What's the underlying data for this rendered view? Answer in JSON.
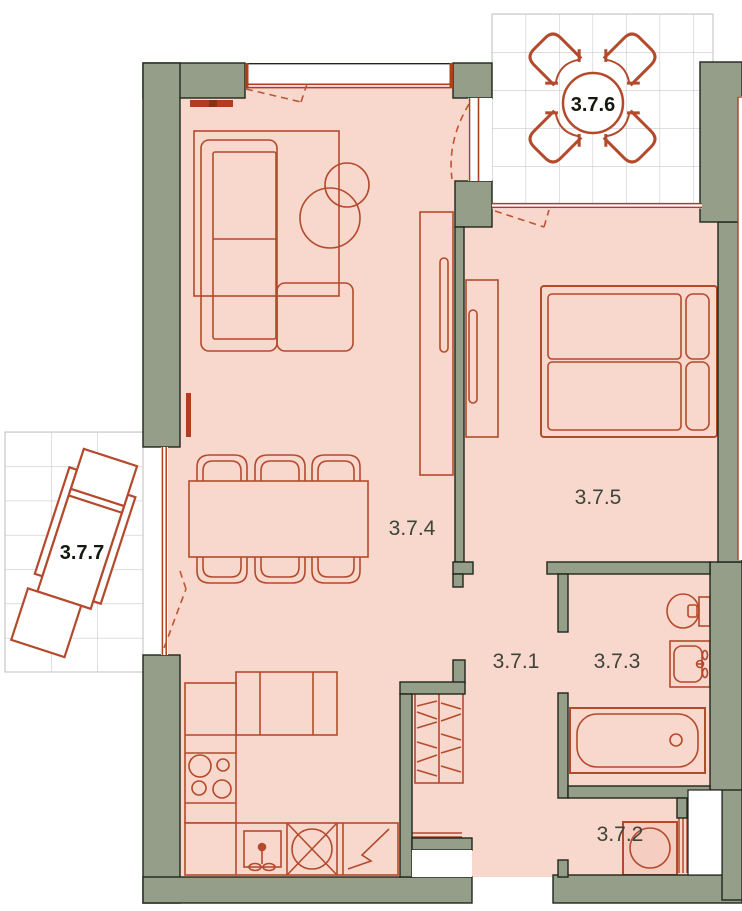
{
  "plan": {
    "title": "apartment-floor-plan",
    "rooms": [
      {
        "label": "3.7.1",
        "kind": "hallway"
      },
      {
        "label": "3.7.2",
        "kind": "laundry"
      },
      {
        "label": "3.7.3",
        "kind": "bathroom"
      },
      {
        "label": "3.7.4",
        "kind": "living-kitchen"
      },
      {
        "label": "3.7.5",
        "kind": "bedroom"
      },
      {
        "label": "3.7.6",
        "kind": "balcony-top"
      },
      {
        "label": "3.7.7",
        "kind": "balcony-left"
      }
    ],
    "colors": {
      "wall_fill": "#949e89",
      "wall_outline": "#20261c",
      "floor_fill": "#f8d7cc",
      "furniture_line": "#b44a2c",
      "window_line": "#b03d1e",
      "door_dash": "#bf5433",
      "tile_grid": "#c9cbc9",
      "room_label": "#3d443a",
      "balcony_label": "#14180f",
      "background": "#ffffff"
    }
  }
}
